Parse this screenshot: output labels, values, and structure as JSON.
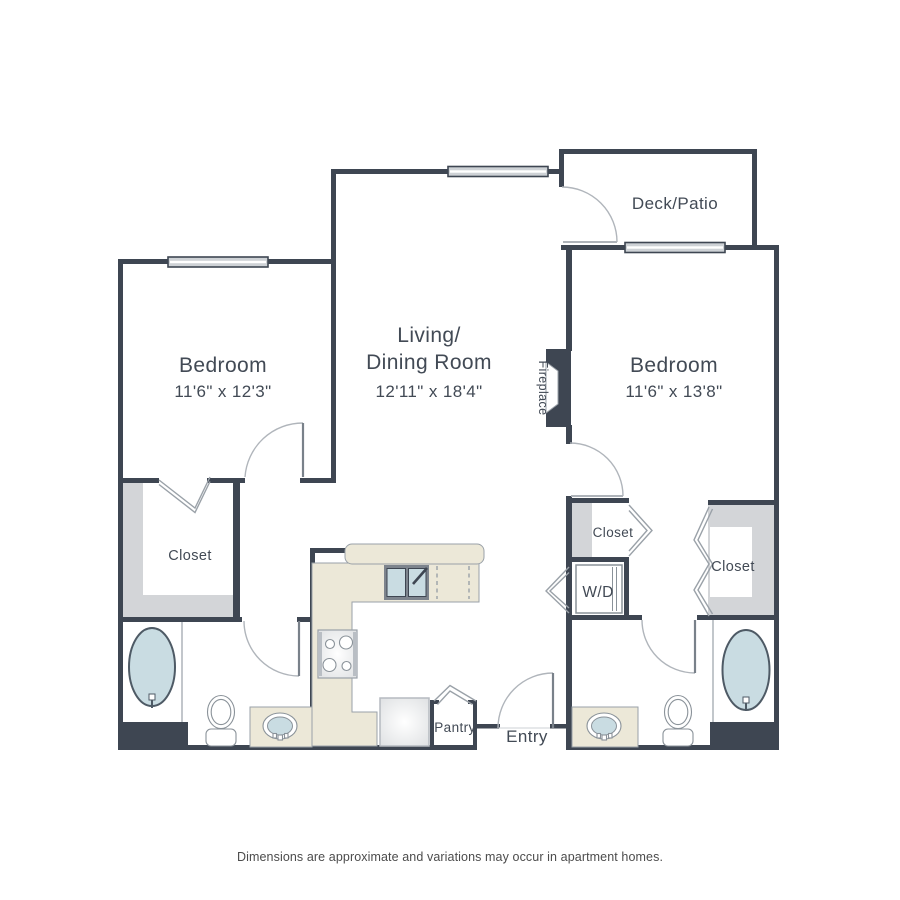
{
  "plan": {
    "rooms": {
      "bedroom_left": {
        "name": "Bedroom",
        "dims": "11'6\" x 12'3\""
      },
      "living": {
        "line1": "Living/",
        "line2": "Dining Room",
        "dims": "12'11\" x 18'4\""
      },
      "bedroom_right": {
        "name": "Bedroom",
        "dims": "11'6\" x 13'8\""
      },
      "deck": {
        "name": "Deck/Patio"
      },
      "fireplace": {
        "name": "Fireplace"
      },
      "closet_bedroom_left": {
        "name": "Closet"
      },
      "closet_hall": {
        "name": "Closet"
      },
      "closet_bedroom_right": {
        "name": "Closet"
      },
      "washer_dryer": {
        "name": "W/D"
      },
      "pantry": {
        "name": "Pantry"
      },
      "entry": {
        "name": "Entry"
      }
    },
    "footer": {
      "disclaimer": "Dimensions are approximate and variations may occur in apartment homes."
    },
    "colors": {
      "wall": "#3e4652",
      "wall_light": "#d3d5d8",
      "counter": "#ece8d8",
      "fixture_blue": "#c9dce2",
      "background": "#ffffff"
    }
  }
}
